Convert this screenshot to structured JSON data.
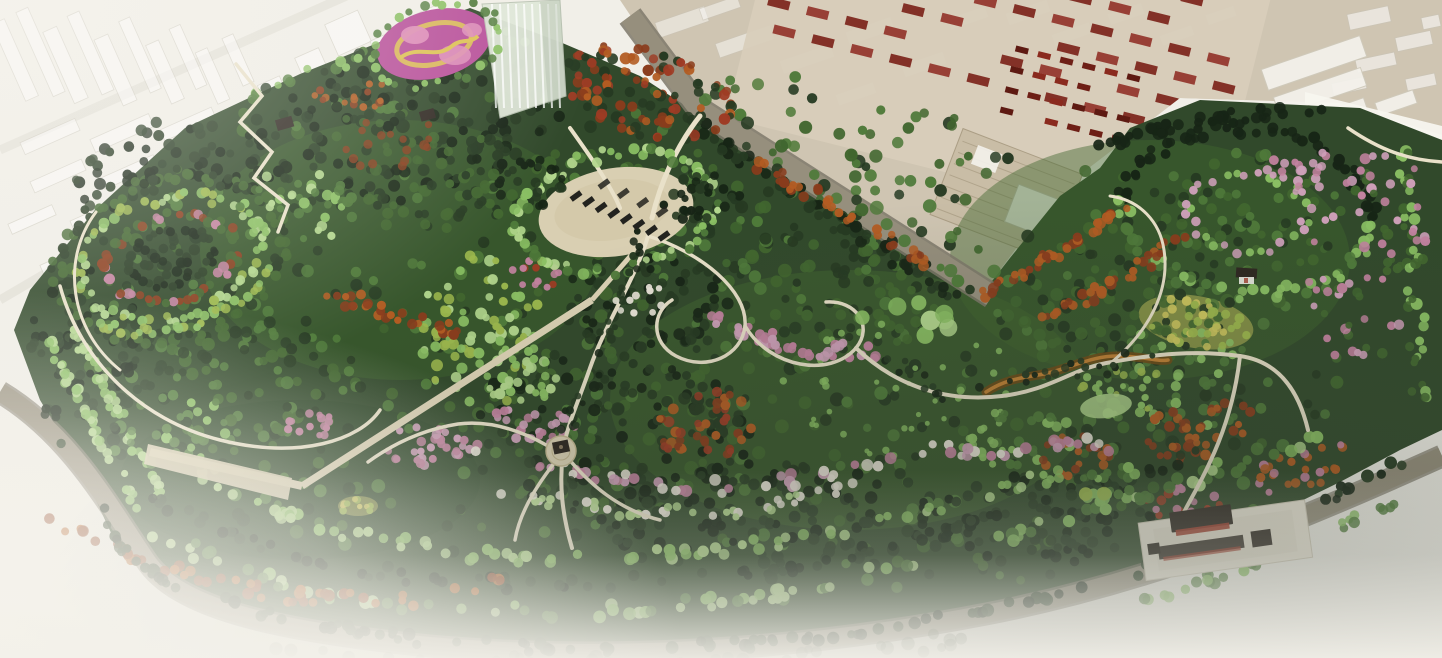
{
  "meta": {
    "description": "Aerial oblique rendering of a large urban park master plan surrounded by ghosted city blocks and an industrial zone",
    "width_px": 1442,
    "height_px": 658
  },
  "palette": {
    "bg": "#f1efe8",
    "ghost_fill": "#ffffff",
    "ghost_stroke": "#c7c3b7",
    "ghost_street": "#e2dfd6",
    "industrial_ground": "#cfc5b2",
    "factory_base": "#d8cdbb",
    "factory_roof_red": "#7c241a",
    "factory_roof_red2": "#93342a",
    "car_red_dark": "#6e1f16",
    "car_red_mid": "#8a2a1e",
    "car_red_deep": "#5e1a12",
    "warehouse_roof": "#c9bda6",
    "warehouse_ridge": "#ab9e85",
    "building_white": "#f4f2ec",
    "wall_white": "#f7f5ef",
    "road": "#968f7d",
    "road_casing": "#7e786a",
    "path": "#e9e1c9",
    "boardwalk": "#ddd3b6",
    "plaza": "#d9cfb2",
    "plaza_shade": "#cfc4a4",
    "park_base": "#31492b",
    "forest_dark": "#263a22",
    "forest_deep": "#172516",
    "green_mid": "#41662f",
    "green_mid2": "#4f7a3a",
    "green_light": "#8abf63",
    "green_pale": "#b2d68d",
    "yellow_green": "#9cb84d",
    "meadow_yellow": "#cfc75e",
    "autumn_orange": "#b35c22",
    "autumn_rust": "#8a3c1c",
    "autumn_red": "#9e3b24",
    "blossom_pink": "#cfa0ba",
    "blossom_pink2": "#c2829f",
    "blossom_white": "#e9e4d8",
    "flower_magenta": "#b84f9a",
    "flower_yellow": "#ddc153",
    "flower_pink": "#dd8cb8",
    "stream_dark": "#6e4a16",
    "stream_light": "#c08034",
    "roof_dark": "#2e2721",
    "temple_wall": "#efe9db",
    "temple_red": "#a33c2c",
    "car_dark": "#23231f",
    "fog": "#f4f2ec",
    "shade_se": "#3a4236"
  },
  "scene": {
    "regions": [
      {
        "name": "ghost-city-northwest",
        "description": "faded white city blocks upper left",
        "color_key": "ghost_fill"
      },
      {
        "name": "industrial-zone-northeast",
        "description": "tan ground plane with factory roof rows and parked red cars",
        "color_key": "industrial_ground"
      },
      {
        "name": "warehouse-building",
        "description": "large ribbed-roof warehouse with white annex",
        "color_key": "warehouse_roof"
      },
      {
        "name": "flower-parterre-garden",
        "description": "magenta and yellow ornamental flower bed at top edge",
        "color_key": "flower_magenta"
      },
      {
        "name": "glass-tower",
        "description": "translucent high-rise at park north edge",
        "color_key": "building_white"
      },
      {
        "name": "central-parking-plaza",
        "description": "oval paved plaza with two rows of parked cars",
        "color_key": "plaza"
      },
      {
        "name": "circular-tree-garden-west",
        "description": "concentric rings of colored trees",
        "color_key": "green_light"
      },
      {
        "name": "birch-grove",
        "description": "bright light-green grove left of center",
        "color_key": "green_pale"
      },
      {
        "name": "cherry-blossom-drifts",
        "description": "pink blossom tree bands through center and south arcs",
        "color_key": "blossom_pink"
      },
      {
        "name": "autumn-tree-rows",
        "description": "orange and rust tree rows",
        "color_key": "autumn_orange"
      },
      {
        "name": "central-pavilion",
        "description": "round plaza with dark-roof pavilion",
        "color_key": "roof_dark"
      },
      {
        "name": "northeast-pavilion",
        "description": "small pavilion in eastern circle garden",
        "color_key": "roof_dark"
      },
      {
        "name": "temple-complex-southeast",
        "description": "walled courtyard halls on white platform",
        "color_key": "temple_wall"
      },
      {
        "name": "dry-stream",
        "description": "meandering orange-brown stream bed east of center",
        "color_key": "stream_light"
      },
      {
        "name": "yellow-meadow",
        "description": "wildflower meadow patch northeast",
        "color_key": "meadow_yellow"
      },
      {
        "name": "winding-paths",
        "description": "white looping footpath network",
        "color_key": "path"
      },
      {
        "name": "perimeter-ring-road",
        "description": "gray road wrapping the park west and south",
        "color_key": "road"
      },
      {
        "name": "fog-vignette",
        "description": "white fade at the lower and left edges",
        "color_key": "fog"
      }
    ]
  }
}
